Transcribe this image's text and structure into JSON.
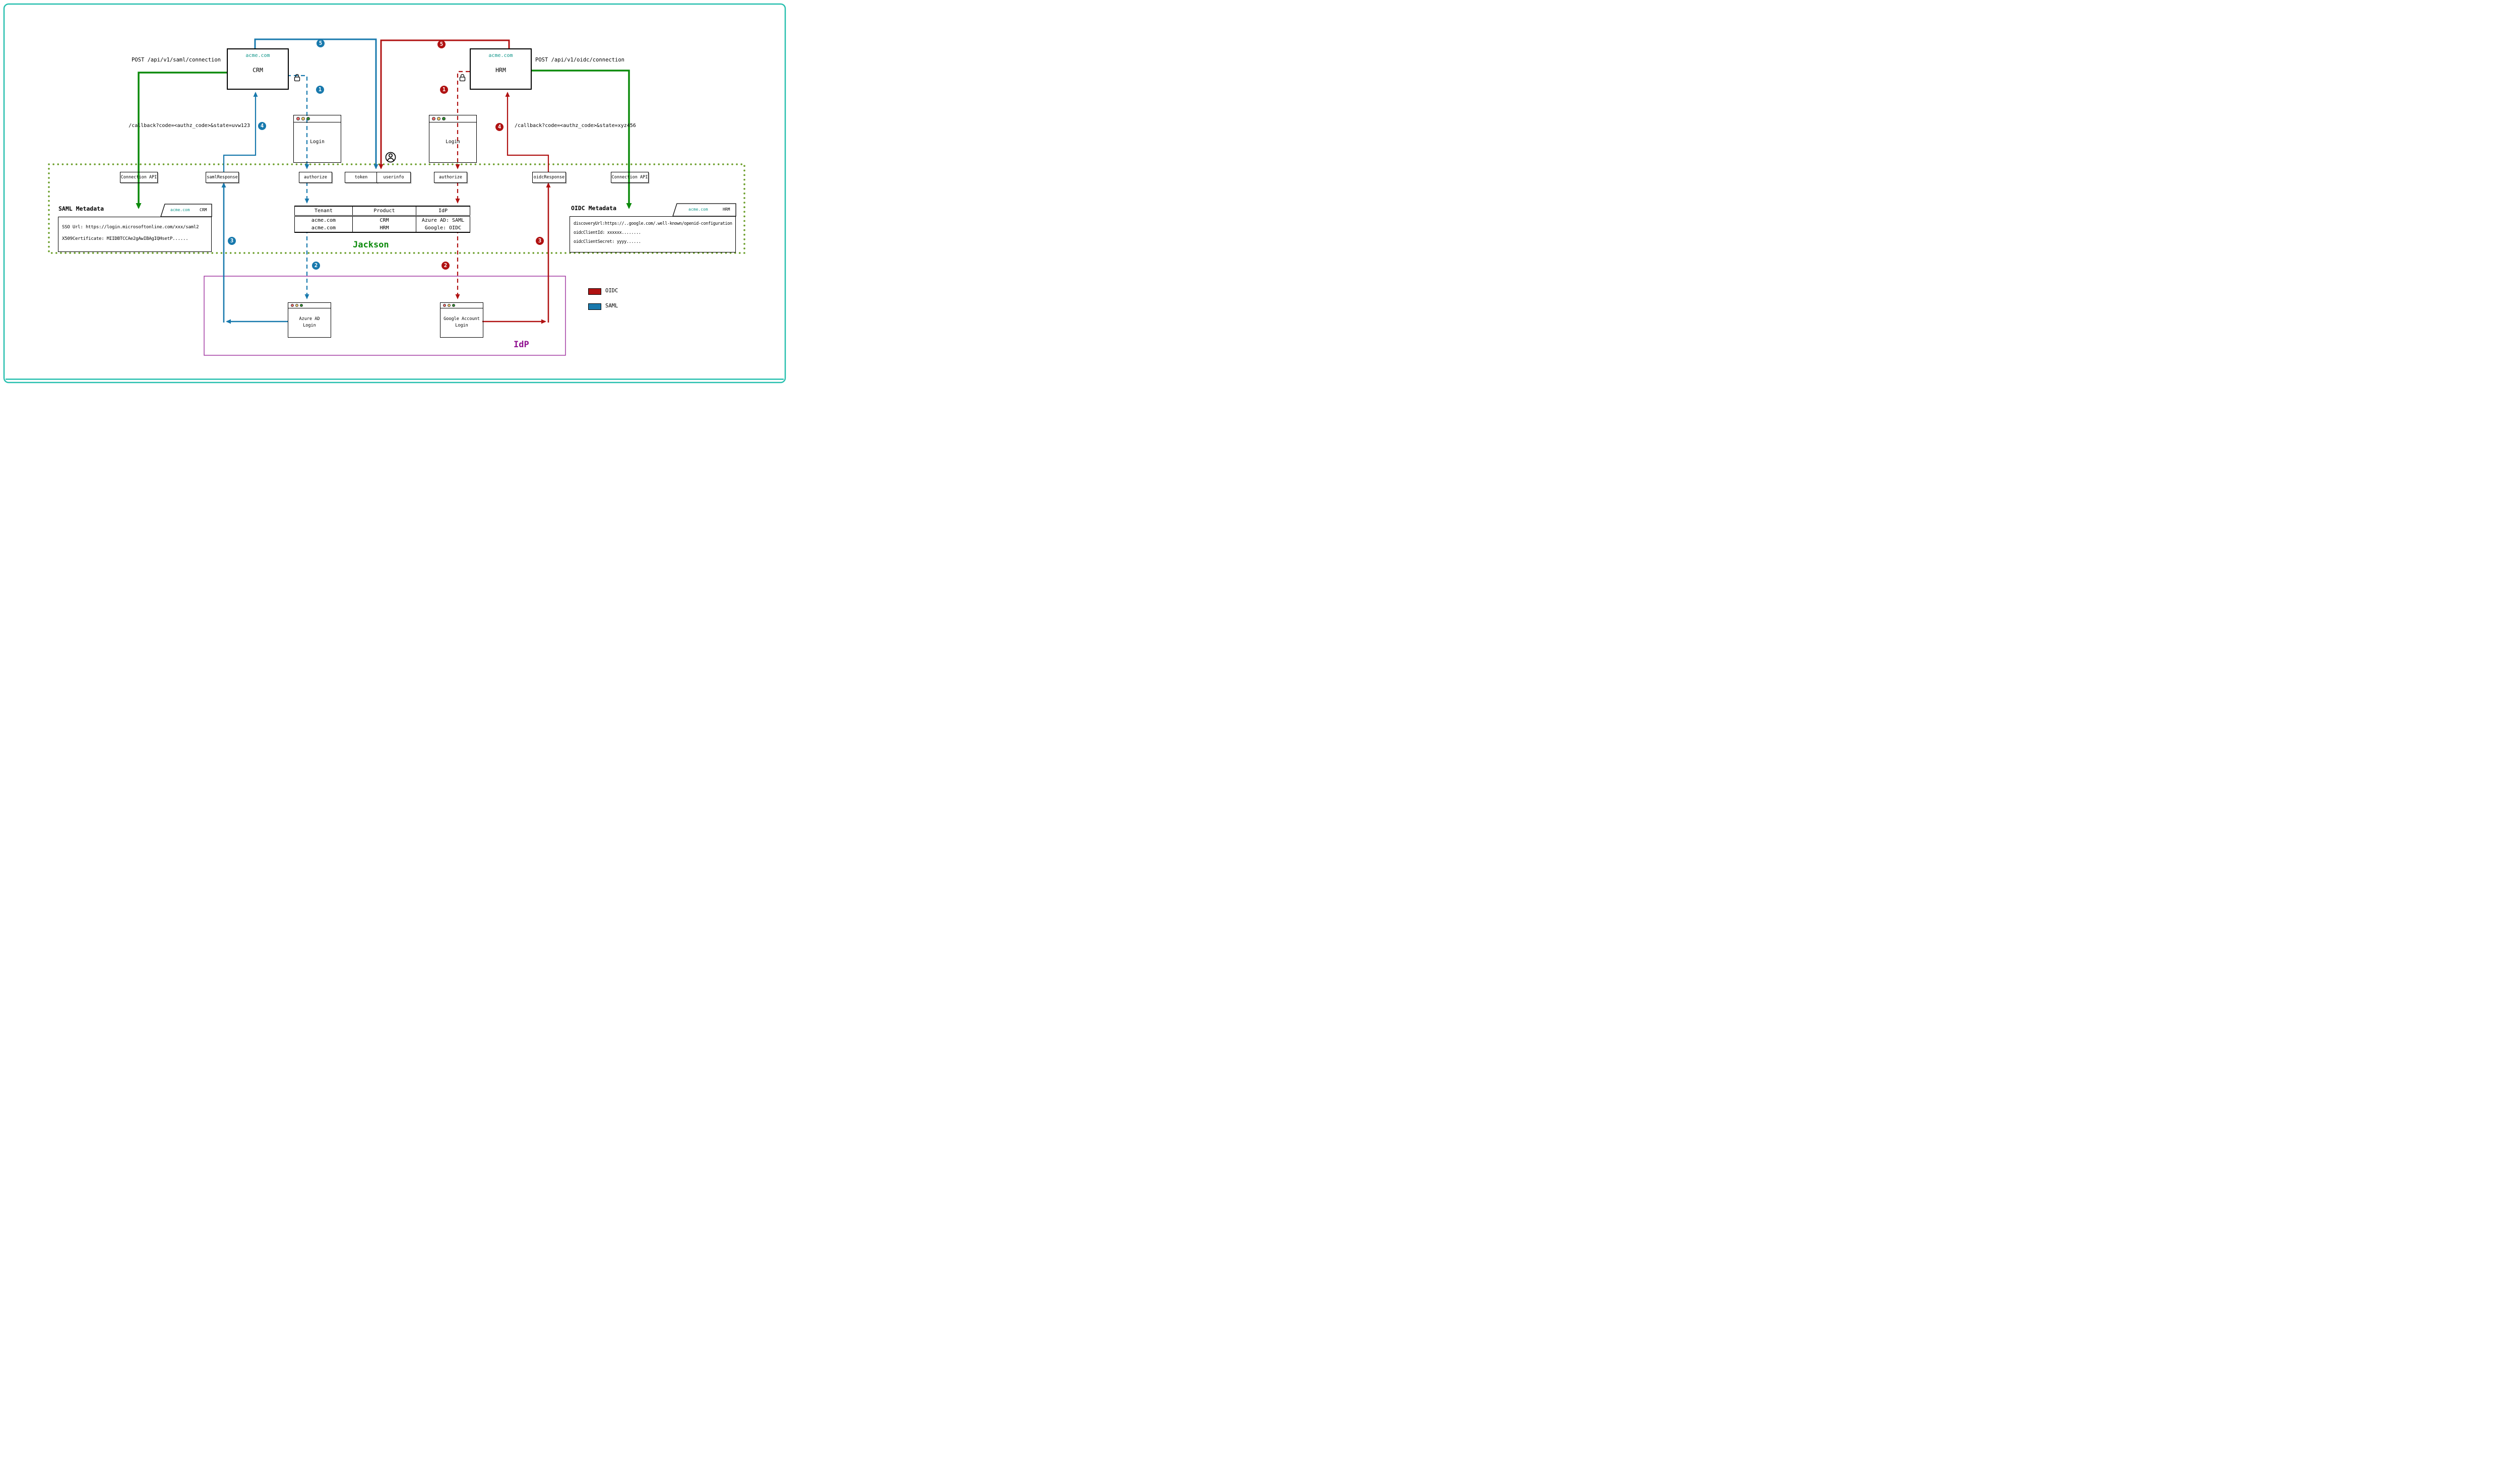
{
  "colors": {
    "saml_blue": "#1879ad",
    "oidc_red": "#b01212",
    "connection_green": "#0b8a0b",
    "jackson_border_olive": "#6b9e2a",
    "acme_teal": "#0d9488",
    "idp_purple": "#8f0f8f",
    "idp_border_pink": "#a23aa2",
    "frame_teal": "#26bfae"
  },
  "apps": {
    "crm": {
      "domain": "acme.com",
      "name": "CRM",
      "api_label": "POST /api/v1/saml/connection",
      "callback": "/callback?code=<authz_code>&state=uvw123"
    },
    "hrm": {
      "domain": "acme.com",
      "name": "HRM",
      "api_label": "POST /api/v1/oidc/connection",
      "callback": "/callback?code=<authz_code>&state=xyz456"
    }
  },
  "browser": {
    "login_left": "Login",
    "login_right": "Login",
    "azure_line1": "Azure AD",
    "azure_line2": "Login",
    "google_line1": "Google Account",
    "google_line2": "Login"
  },
  "jackson": {
    "label": "Jackson",
    "endpoints": {
      "connection_api_left": "Connection API",
      "saml_response": "samlResponse",
      "authorize_left": "authorize",
      "token": "token",
      "userinfo": "userinfo",
      "authorize_right": "authorize",
      "oidc_response": "oidcResponse",
      "connection_api_right": "Connection API"
    },
    "saml_metadata": {
      "title": "SAML Metadata",
      "tab_domain": "acme.com",
      "tab_product": "CRM",
      "lines": [
        "SSO Url: https://login.microsoftonline.com/xxx/saml2",
        "X509Certificate: MIIDBTCCAe2gAwIBAgIQHsetP......"
      ]
    },
    "oidc_metadata": {
      "title": "OIDC Metadata",
      "tab_domain": "acme.com",
      "tab_product": "HRM",
      "lines": [
        "discoveryUrl:https://..google.com/.well-known/openid-configuration",
        "oidcClientId: xxxxxx........",
        "oidcClientSecret: yyyy......"
      ]
    },
    "table": {
      "headers": [
        "Tenant",
        "Product",
        "IdP"
      ],
      "rows": [
        [
          "acme.com",
          "CRM",
          "Azure AD: SAML"
        ],
        [
          "acme.com",
          "HRM",
          "Google: OIDC"
        ]
      ]
    }
  },
  "idp_label": "IdP",
  "legend": {
    "oidc": "OIDC",
    "saml": "SAML"
  },
  "steps": {
    "one": "1",
    "two": "2",
    "three": "3",
    "four": "4",
    "five": "5"
  }
}
